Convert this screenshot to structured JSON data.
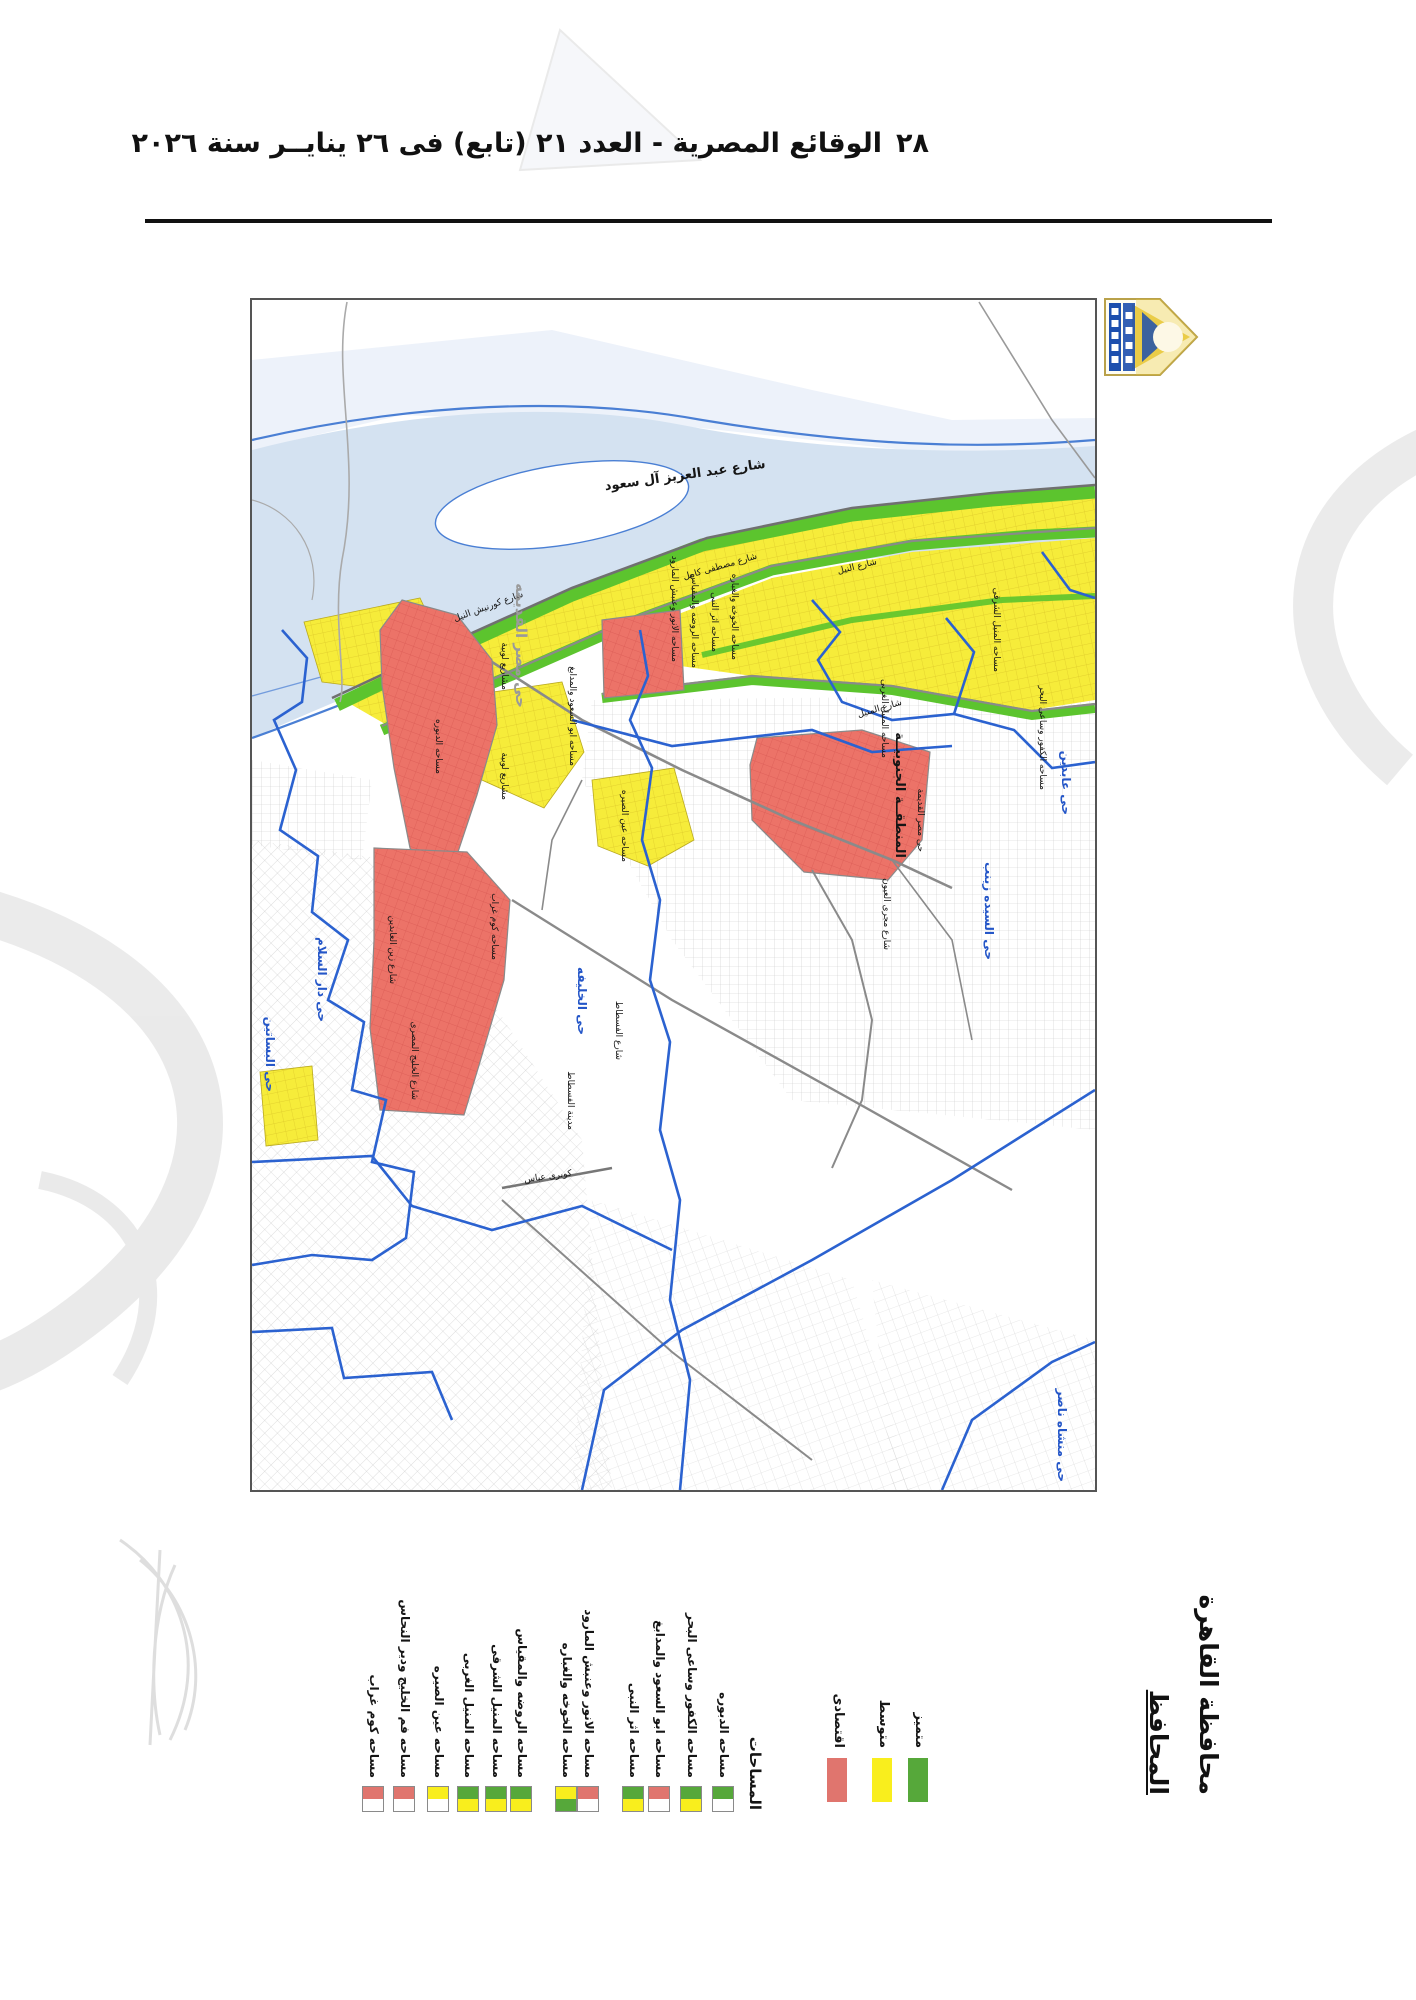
{
  "page": {
    "number": "٢٨",
    "header": "الوقائع المصرية - العدد ٢١ (تابع) فى ٢٦ ينايــر سنة ٢٠٢٦"
  },
  "signature": {
    "line1": "محافظة القاهرة",
    "line2": "المحافظ"
  },
  "legend": {
    "title": "المساحات",
    "categories": [
      {
        "label": "متميز",
        "color": "#56a83a"
      },
      {
        "label": "متوسط",
        "color": "#f9ee1d"
      },
      {
        "label": "اقتصادى",
        "color": "#e0756e"
      }
    ],
    "entries": [
      {
        "name": "مساحه الدبوره",
        "top": "#56a83a",
        "bottom": "#ffffff"
      },
      {
        "name": "مساحه الكفور وساعى البحر",
        "top": "#56a83a",
        "bottom": "#f9ee1d"
      },
      {
        "name": "مساحه ابو السعود والمدابغ",
        "top": "#e0756e",
        "bottom": "#ffffff"
      },
      {
        "name": "مساحه اثر النبى",
        "top": "#56a83a",
        "bottom": "#f9ee1d"
      },
      {
        "name": "مساحه الانور وعنبش المارود",
        "top": "#e0756e",
        "bottom": "#ffffff"
      },
      {
        "name": "مساحه الخوخه والغباره",
        "top": "#f9ee1d",
        "bottom": "#56a83a"
      },
      {
        "name": "مساحه الروضه والمقياس",
        "top": "#56a83a",
        "bottom": "#f9ee1d"
      },
      {
        "name": "مساحه المنيل الشرقى",
        "top": "#56a83a",
        "bottom": "#f9ee1d"
      },
      {
        "name": "مساحه المنيل الغربى",
        "top": "#56a83a",
        "bottom": "#f9ee1d"
      },
      {
        "name": "مساحه عين الصيره",
        "top": "#f9ee1d",
        "bottom": "#ffffff"
      },
      {
        "name": "مساحه فم الخليج ودير النحاس",
        "top": "#e0756e",
        "bottom": "#ffffff"
      },
      {
        "name": "مساحه كوم غراب",
        "top": "#e0756e",
        "bottom": "#ffffff"
      }
    ]
  },
  "map": {
    "colors": {
      "river": "#d4e2f1",
      "river_light": "#edf2fa",
      "bank_line": "#4a7fd4",
      "green_zone": "#5cc42e",
      "yellow_zone": "#f6ec3a",
      "red_zone": "#ec7368",
      "boundary_blue": "#2b62d0",
      "road_gray": "#8a8a8a"
    },
    "labels": [
      {
        "text": "شارع عبد العزيز آل سعود"
      },
      {
        "text": "شارع النيل"
      },
      {
        "text": "شارع كورنيش النيل"
      },
      {
        "text": "شارع مصطفى كامل"
      },
      {
        "text": "شارع المنيل"
      },
      {
        "text": "مساحه الروضه والمقياس"
      },
      {
        "text": "مساحه اثر النبى"
      },
      {
        "text": "مساحه الخوخه والغباره"
      },
      {
        "text": "مساحه الانور وعنبش المارود"
      },
      {
        "text": "مساحه المنيل الشرقى"
      },
      {
        "text": "مساحه المنيل الغربى"
      },
      {
        "text": "مساحه الكفور وساعى البحر"
      },
      {
        "text": "مساحه ابو السعود والمدابغ"
      },
      {
        "text": "مساحه عين الصيره"
      },
      {
        "text": "مساحه كوم غراب"
      },
      {
        "text": "مساحه الدبوره"
      },
      {
        "text": "مشاريع لوبية"
      },
      {
        "text": "مشاريع لوبية"
      },
      {
        "text": "شارع مجرى العيون"
      },
      {
        "text": "مدينة الفسطاط"
      },
      {
        "text": "شارع الفسطاط"
      },
      {
        "text": "شارع زين العابدين"
      },
      {
        "text": "شارع الخليج المصرى"
      },
      {
        "text": "كوبرى عباس"
      },
      {
        "text": "حى مصر القديمه"
      },
      {
        "text": "المنطقــة الجنوبيــة"
      },
      {
        "text": "حى مصر القديمة"
      },
      {
        "text": "حى السيده زينب"
      },
      {
        "text": "حى عابدين"
      },
      {
        "text": "حى الخليفه"
      },
      {
        "text": "حى دار السلام"
      },
      {
        "text": "حى البساتين"
      },
      {
        "text": "حى منشاه ناصر"
      }
    ]
  }
}
